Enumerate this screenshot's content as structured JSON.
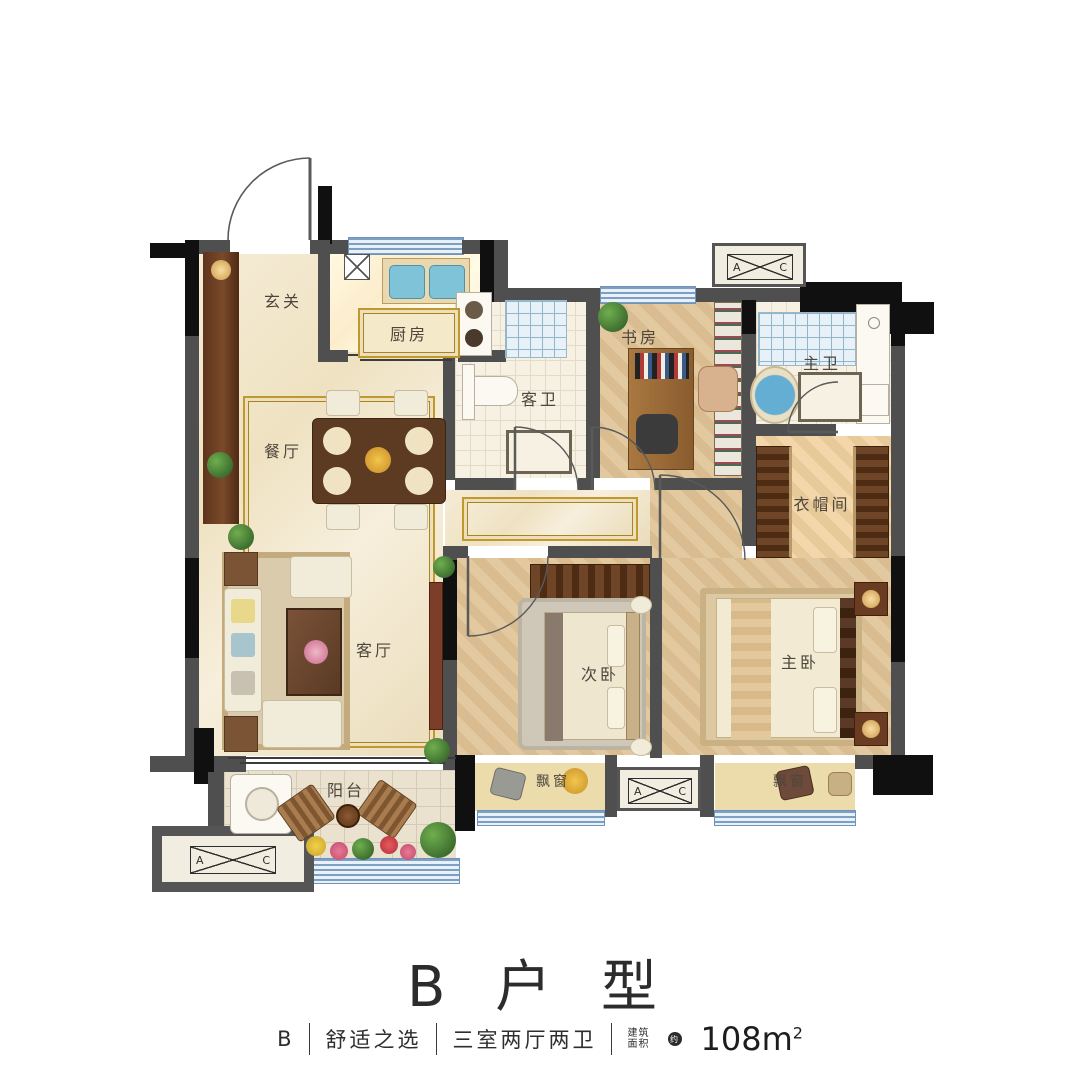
{
  "footer": {
    "title": "B 户 型",
    "plan_letter": "B",
    "tagline": "舒适之选",
    "layout": "三室两厅两卫",
    "area_label_line1": "建筑",
    "area_label_line2": "面积",
    "area_approx": "约",
    "area_value": "108m",
    "area_exp": "2"
  },
  "rooms": {
    "entry": "玄关",
    "kitchen": "厨房",
    "dining": "餐厅",
    "living": "客厅",
    "balcony": "阳台",
    "guest_bath": "客卫",
    "study": "书房",
    "master_bath": "主卫",
    "closet": "衣帽间",
    "second_bedroom": "次卧",
    "master_bedroom": "主卧",
    "bay_window_left": "飘窗",
    "bay_window_right": "飘窗"
  },
  "ac": {
    "a": "A",
    "c": "C"
  },
  "colors": {
    "wall_gray": "#4f4f4f",
    "column_black": "#101010",
    "window_blue": "#7d9fc4",
    "marble_cream": "#f1e6cc",
    "wood_tan": "#ddc194",
    "accent_gold": "#c0992e",
    "fixture_blue": "#64aed4"
  }
}
